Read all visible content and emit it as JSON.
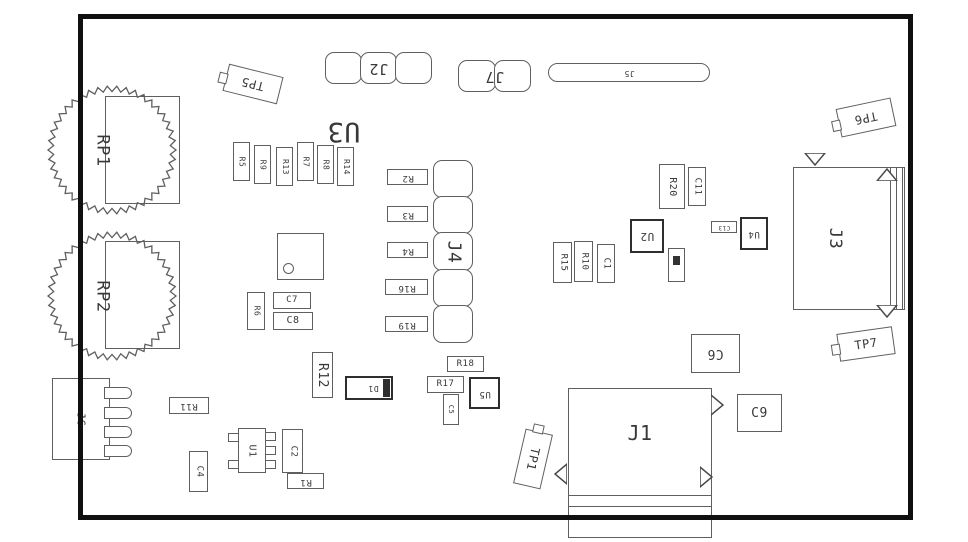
{
  "styles": {
    "line": "#5f5f5f",
    "thick": "#2e2e2e",
    "text": "#383838",
    "board_outline": "#101010",
    "background": "#ffffff"
  },
  "board": {
    "x": 78,
    "y": 14,
    "w": 835,
    "h": 506
  },
  "components": [
    {
      "id": "potentiometer-rp1-body",
      "type": "gear",
      "cx": 112,
      "cy": 150,
      "r": 64,
      "teeth": 42
    },
    {
      "id": "potentiometer-rp2-body",
      "type": "gear",
      "cx": 112,
      "cy": 296,
      "r": 64,
      "teeth": 42
    },
    {
      "id": "potentiometer-rp1-pad",
      "type": "rect",
      "x": 105,
      "y": 96,
      "w": 75,
      "h": 108,
      "bg": "none"
    },
    {
      "id": "potentiometer-rp2-pad",
      "type": "rect",
      "x": 105,
      "y": 241,
      "w": 75,
      "h": 108,
      "bg": "none"
    },
    {
      "id": "potentiometer-rp1-label",
      "type": "text",
      "x": 86,
      "y": 120,
      "w": 32,
      "h": 60,
      "label": "RP1",
      "lrot": 90,
      "size": 17
    },
    {
      "id": "potentiometer-rp2-label",
      "type": "text",
      "x": 86,
      "y": 266,
      "w": 32,
      "h": 60,
      "label": "RP2",
      "lrot": 90,
      "size": 17
    },
    {
      "id": "testpoint-tp5",
      "type": "tab",
      "x": 225,
      "y": 70,
      "w": 56,
      "h": 28,
      "tilt": 14,
      "label": "TP5",
      "lrot": 180,
      "size": 12
    },
    {
      "id": "connector-j2",
      "type": "lobes",
      "dir": "h",
      "n": 3,
      "x": 325,
      "y": 52,
      "w": 107,
      "h": 32,
      "label": "J2",
      "lrot": 180,
      "size": 15
    },
    {
      "id": "connector-j7",
      "type": "lobes",
      "dir": "h",
      "n": 2,
      "x": 458,
      "y": 60,
      "w": 73,
      "h": 32,
      "label": "J7",
      "lrot": 180,
      "size": 15
    },
    {
      "id": "slot-j5",
      "type": "slot",
      "x": 548,
      "y": 63,
      "w": 162,
      "h": 19,
      "label": "J5",
      "lrot": 180,
      "size": 8
    },
    {
      "id": "testpoint-tp6",
      "type": "tab",
      "x": 838,
      "y": 103,
      "w": 56,
      "h": 29,
      "tilt": -12,
      "label": "TP6",
      "lrot": 180,
      "size": 12
    },
    {
      "id": "ic-u3-label",
      "type": "text",
      "x": 322,
      "y": 103,
      "w": 44,
      "h": 56,
      "label": "U3",
      "lrot": 180,
      "size": 27
    },
    {
      "id": "resistor-r5",
      "type": "rect",
      "x": 233,
      "y": 142,
      "w": 17,
      "h": 39,
      "label": "R5",
      "lrot": 90,
      "size": 8
    },
    {
      "id": "resistor-r9",
      "type": "rect",
      "x": 254,
      "y": 145,
      "w": 17,
      "h": 39,
      "label": "R9",
      "lrot": 90,
      "size": 8
    },
    {
      "id": "resistor-r13",
      "type": "rect",
      "x": 276,
      "y": 147,
      "w": 17,
      "h": 39,
      "label": "R13",
      "lrot": 90,
      "size": 8
    },
    {
      "id": "resistor-r7",
      "type": "rect",
      "x": 297,
      "y": 142,
      "w": 17,
      "h": 39,
      "label": "R7",
      "lrot": 90,
      "size": 8
    },
    {
      "id": "resistor-r8",
      "type": "rect",
      "x": 317,
      "y": 145,
      "w": 17,
      "h": 39,
      "label": "R8",
      "lrot": 90,
      "size": 8
    },
    {
      "id": "resistor-r14",
      "type": "rect",
      "x": 337,
      "y": 147,
      "w": 17,
      "h": 39,
      "label": "R14",
      "lrot": 90,
      "size": 8
    },
    {
      "id": "resistor-r2",
      "type": "rect",
      "x": 387,
      "y": 169,
      "w": 41,
      "h": 16,
      "label": "R2",
      "lrot": 180,
      "size": 9
    },
    {
      "id": "resistor-r3",
      "type": "rect",
      "x": 387,
      "y": 206,
      "w": 41,
      "h": 16,
      "label": "R3",
      "lrot": 180,
      "size": 9
    },
    {
      "id": "resistor-r4",
      "type": "rect",
      "x": 387,
      "y": 242,
      "w": 41,
      "h": 16,
      "label": "R4",
      "lrot": 180,
      "size": 9
    },
    {
      "id": "resistor-r16",
      "type": "rect",
      "x": 385,
      "y": 279,
      "w": 43,
      "h": 16,
      "label": "R16",
      "lrot": 180,
      "size": 9
    },
    {
      "id": "resistor-r19",
      "type": "rect",
      "x": 385,
      "y": 316,
      "w": 43,
      "h": 16,
      "label": "R19",
      "lrot": 180,
      "size": 9
    },
    {
      "id": "connector-j4",
      "type": "lobes",
      "dir": "v",
      "n": 5,
      "x": 433,
      "y": 160,
      "w": 40,
      "h": 183,
      "label": "J4",
      "lrot": 90,
      "size": 18
    },
    {
      "id": "ic-unlabeled",
      "type": "icdot",
      "x": 277,
      "y": 233,
      "w": 47,
      "h": 47
    },
    {
      "id": "capacitor-c7",
      "type": "rect",
      "x": 273,
      "y": 292,
      "w": 38,
      "h": 17,
      "label": "C7",
      "lrot": 0,
      "size": 9
    },
    {
      "id": "capacitor-c8",
      "type": "rect",
      "x": 273,
      "y": 312,
      "w": 40,
      "h": 18,
      "label": "C8",
      "lrot": 0,
      "size": 10
    },
    {
      "id": "resistor-r6",
      "type": "rect",
      "x": 247,
      "y": 292,
      "w": 18,
      "h": 38,
      "label": "R6",
      "lrot": 90,
      "size": 8
    },
    {
      "id": "resistor-r12",
      "type": "rect",
      "x": 312,
      "y": 352,
      "w": 21,
      "h": 46,
      "label": "R12",
      "lrot": 90,
      "size": 13
    },
    {
      "id": "diode-d1",
      "type": "diode",
      "x": 345,
      "y": 376,
      "w": 48,
      "h": 24,
      "label": "D1",
      "lrot": 180,
      "size": 8
    },
    {
      "id": "resistor-r11",
      "type": "rect",
      "x": 169,
      "y": 397,
      "w": 40,
      "h": 17,
      "label": "R11",
      "lrot": 180,
      "size": 9
    },
    {
      "id": "connector-j6",
      "type": "j6",
      "x": 52,
      "y": 378,
      "w": 58,
      "h": 82,
      "label": "J6",
      "lrot": 90,
      "size": 11
    },
    {
      "id": "capacitor-c4",
      "type": "rect",
      "x": 189,
      "y": 451,
      "w": 19,
      "h": 41,
      "label": "C4",
      "lrot": 90,
      "size": 9
    },
    {
      "id": "ic-u1",
      "type": "sot",
      "x": 238,
      "y": 428,
      "w": 28,
      "h": 45,
      "label": "U1",
      "lrot": 90,
      "size": 10
    },
    {
      "id": "capacitor-c2",
      "type": "rect",
      "x": 282,
      "y": 429,
      "w": 21,
      "h": 44,
      "label": "C2",
      "lrot": 90,
      "size": 9
    },
    {
      "id": "resistor-r1",
      "type": "rect",
      "x": 287,
      "y": 473,
      "w": 37,
      "h": 16,
      "label": "R1",
      "lrot": 180,
      "size": 9
    },
    {
      "id": "resistor-r18",
      "type": "rect",
      "x": 447,
      "y": 356,
      "w": 37,
      "h": 16,
      "label": "R18",
      "lrot": 0,
      "size": 9
    },
    {
      "id": "resistor-r17",
      "type": "rect",
      "x": 427,
      "y": 376,
      "w": 37,
      "h": 17,
      "label": "R17",
      "lrot": 0,
      "size": 9
    },
    {
      "id": "capacitor-c5",
      "type": "rect",
      "x": 443,
      "y": 394,
      "w": 16,
      "h": 31,
      "label": "C5",
      "lrot": 90,
      "size": 7
    },
    {
      "id": "ic-u5",
      "type": "thick",
      "x": 469,
      "y": 377,
      "w": 31,
      "h": 32,
      "label": "U5",
      "lrot": 180,
      "size": 9
    },
    {
      "id": "testpoint-tp1",
      "type": "tab",
      "x": 505,
      "y": 445,
      "w": 56,
      "h": 28,
      "tilt": 103,
      "label": "TP1",
      "lrot": 0,
      "size": 12
    },
    {
      "id": "connector-j1",
      "type": "j1",
      "x": 568,
      "y": 388,
      "w": 144,
      "h": 150,
      "label": "J1",
      "size": 20,
      "lines": [
        106,
        117
      ]
    },
    {
      "id": "capacitor-c6",
      "type": "rect",
      "x": 691,
      "y": 334,
      "w": 49,
      "h": 39,
      "label": "C6",
      "lrot": 180,
      "size": 13
    },
    {
      "id": "capacitor-c9",
      "type": "rect",
      "x": 737,
      "y": 394,
      "w": 45,
      "h": 38,
      "label": "C9",
      "lrot": 0,
      "size": 13
    },
    {
      "id": "resistor-r15",
      "type": "rect",
      "x": 553,
      "y": 242,
      "w": 19,
      "h": 41,
      "label": "R15",
      "lrot": 90,
      "size": 9
    },
    {
      "id": "resistor-r10",
      "type": "rect",
      "x": 574,
      "y": 241,
      "w": 19,
      "h": 41,
      "label": "R10",
      "lrot": 90,
      "size": 9
    },
    {
      "id": "capacitor-c1",
      "type": "rect",
      "x": 597,
      "y": 244,
      "w": 18,
      "h": 39,
      "label": "C1",
      "lrot": 90,
      "size": 9
    },
    {
      "id": "ic-u2",
      "type": "thick",
      "x": 630,
      "y": 219,
      "w": 34,
      "h": 34,
      "label": "U2",
      "lrot": 180,
      "size": 11
    },
    {
      "id": "resistor-r20",
      "type": "rect",
      "x": 659,
      "y": 164,
      "w": 26,
      "h": 45,
      "label": "R20",
      "lrot": 90,
      "size": 10
    },
    {
      "id": "capacitor-c11",
      "type": "rect",
      "x": 688,
      "y": 167,
      "w": 18,
      "h": 39,
      "label": "C11",
      "lrot": 90,
      "size": 9
    },
    {
      "id": "small-part-unlabeled",
      "type": "tinymark",
      "x": 668,
      "y": 248,
      "w": 17,
      "h": 34
    },
    {
      "id": "capacitor-c13",
      "type": "rect",
      "x": 711,
      "y": 221,
      "w": 26,
      "h": 12,
      "label": "C13",
      "lrot": 180,
      "size": 6
    },
    {
      "id": "ic-u4",
      "type": "thick",
      "x": 740,
      "y": 217,
      "w": 28,
      "h": 33,
      "label": "U4",
      "lrot": 180,
      "size": 9
    },
    {
      "id": "connector-j3",
      "type": "j3",
      "x": 793,
      "y": 167,
      "w": 112,
      "h": 143,
      "label": "J3",
      "size": 17,
      "vlines": [
        96,
        102,
        108
      ]
    },
    {
      "id": "testpoint-tp7",
      "type": "tab",
      "x": 838,
      "y": 330,
      "w": 56,
      "h": 28,
      "tilt": -8,
      "label": "TP7",
      "lrot": 0,
      "size": 12
    },
    {
      "id": "j1-notch-left",
      "type": "tri",
      "x": 554,
      "y": 463,
      "w": 13,
      "h": 22,
      "dir": "left"
    },
    {
      "id": "j1-notch-right-top",
      "type": "tri",
      "x": 711,
      "y": 394,
      "w": 13,
      "h": 22,
      "dir": "right"
    },
    {
      "id": "j1-notch-right-bottom",
      "type": "tri",
      "x": 700,
      "y": 466,
      "w": 13,
      "h": 22,
      "dir": "right"
    },
    {
      "id": "j3-notch-top-left",
      "type": "tri",
      "x": 804,
      "y": 153,
      "w": 22,
      "h": 13,
      "dir": "down"
    },
    {
      "id": "j3-notch-top-right",
      "type": "tri",
      "x": 876,
      "y": 168,
      "w": 22,
      "h": 13,
      "dir": "up"
    },
    {
      "id": "j3-notch-bottom",
      "type": "tri",
      "x": 876,
      "y": 305,
      "w": 22,
      "h": 13,
      "dir": "down"
    }
  ]
}
